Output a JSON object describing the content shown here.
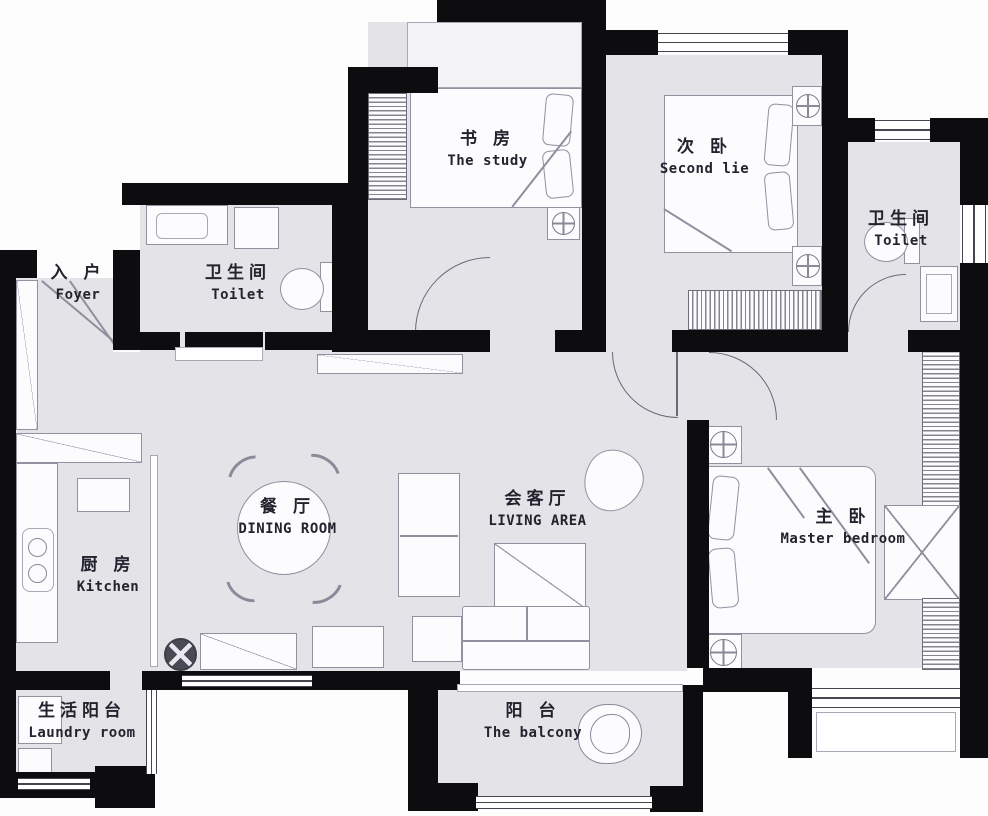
{
  "meta": {
    "kind": "apartment floor plan",
    "style": "black walls, gray floors, white furniture outlines"
  },
  "palette": {
    "wall": "#0d0d10",
    "floor": "#e3e3e8",
    "outline": "#9191a0",
    "text": "#23232e",
    "background": "#fdfdfd"
  },
  "rooms": [
    {
      "id": "foyer",
      "zh": "入 户",
      "en": "Foyer"
    },
    {
      "id": "toilet-a",
      "zh": "卫生间",
      "en": "Toilet"
    },
    {
      "id": "study",
      "zh": "书 房",
      "en": "The study"
    },
    {
      "id": "second-bedroom",
      "zh": "次 卧",
      "en": "Second lie"
    },
    {
      "id": "toilet-b",
      "zh": "卫生间",
      "en": "Toilet"
    },
    {
      "id": "dining-room",
      "zh": "餐 厅",
      "en": "DINING ROOM"
    },
    {
      "id": "living-area",
      "zh": "会客厅",
      "en": "LIVING AREA"
    },
    {
      "id": "master-bedroom",
      "zh": "主 卧",
      "en": "Master bedroom"
    },
    {
      "id": "kitchen",
      "zh": "厨 房",
      "en": "Kitchen"
    },
    {
      "id": "laundry",
      "zh": "生活阳台",
      "en": "Laundry room"
    },
    {
      "id": "balcony",
      "zh": "阳 台",
      "en": "The balcony"
    }
  ]
}
